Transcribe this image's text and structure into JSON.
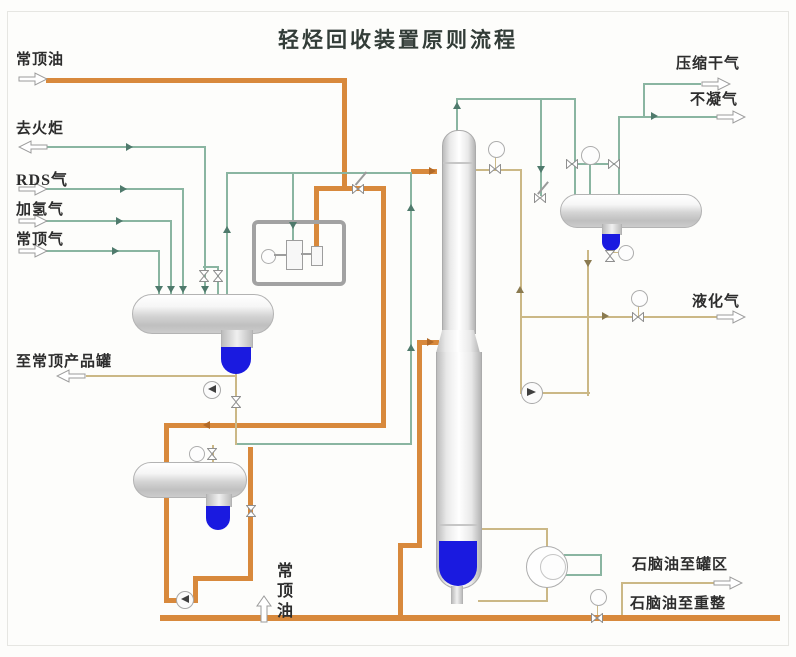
{
  "title": "轻烃回收装置原则流程",
  "streams": {
    "atm_overhead_oil_top": "常顶油",
    "to_flare": "去火炬",
    "rds_gas": "RDS气",
    "hydrogenation_gas": "加氢气",
    "atm_overhead_gas": "常顶气",
    "to_atm_overhead_product_tank": "至常顶产品罐",
    "compressed_dry_gas": "压缩干气",
    "non_condensable_gas": "不凝气",
    "lpg": "液化气",
    "naphtha_to_tank_farm": "石脑油至罐区",
    "naphtha_to_reforming": "石脑油至重整",
    "atm_overhead_oil_bottom": "常顶油"
  },
  "colors": {
    "process_line_orange": "#d8893c",
    "gas_line_green": "#8ab5a1",
    "liquid_line_tan": "#cbb886",
    "liquid_blue": "#1a1ae0",
    "equipment_gray": "#c9c9c9"
  }
}
